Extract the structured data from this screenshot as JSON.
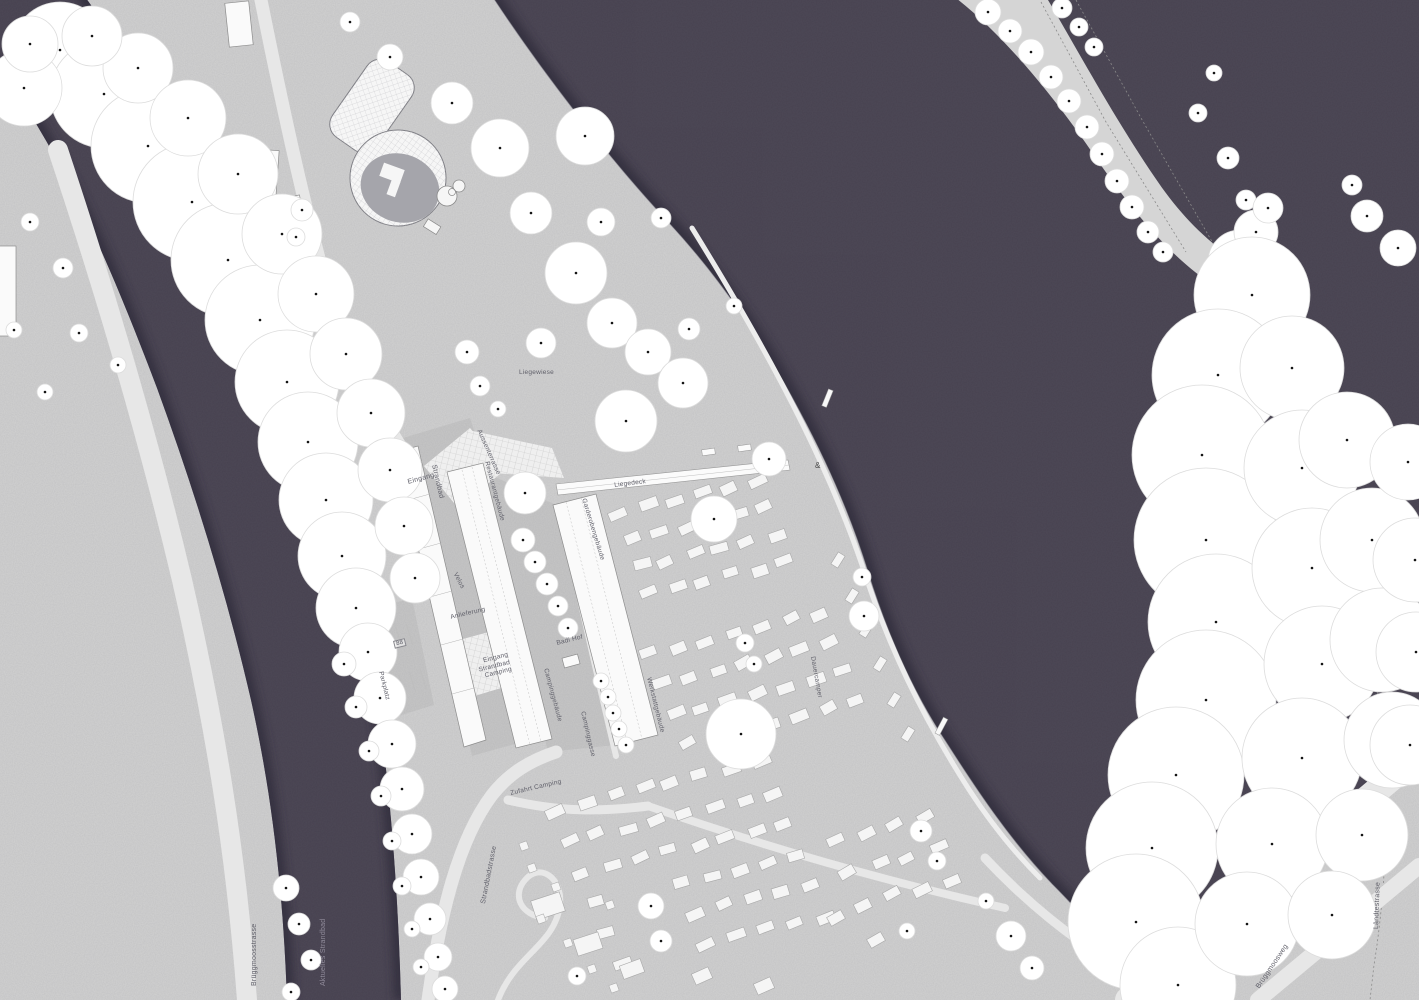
{
  "title": "Situationsplan Strandbad und Camping",
  "colors": {
    "ground": "#d2d2d2",
    "ground_patch": "#c1c1c1",
    "water": "#474250",
    "water_edge": "#322e3c",
    "tree_fill": "#ffffff",
    "tree_stroke": "#dcdcdc",
    "tree_dot": "#141414",
    "building_fill": "#fafafa",
    "building_stroke": "#8d8d8d",
    "caravan_fill": "#f5f5f5",
    "caravan_stroke": "#a8a8a8",
    "road": "#e7e7e7",
    "pool_gray": "#a5a5ab",
    "label": "#60606a",
    "label_on_water": "#928d9c"
  },
  "labels": [
    {
      "id": "liegewiese",
      "text": "Liegewiese",
      "x": 519,
      "y": 370,
      "rot": 0,
      "size": 6.5
    },
    {
      "id": "liegedeck",
      "text": "Liegedeck",
      "x": 614,
      "y": 483,
      "rot": -7,
      "size": 6.5
    },
    {
      "id": "eingang-strandbad",
      "text": "Eingang",
      "x": 407,
      "y": 479,
      "rot": -15
    },
    {
      "id": "strandbad-vertical",
      "text": "Strandbad",
      "x": 437,
      "y": 464,
      "rot": 77
    },
    {
      "id": "aussenterrasse",
      "text": "Aussenterrasse",
      "x": 481,
      "y": 429,
      "rot": 66,
      "size": 6.5
    },
    {
      "id": "restaurantgebaeude",
      "text": "Restaurantgebäude",
      "x": 489,
      "y": 461,
      "rot": 75,
      "size": 6.5
    },
    {
      "id": "garderobengebaeude",
      "text": "Garderobengebäude",
      "x": 586,
      "y": 498,
      "rot": 73,
      "size": 6.5
    },
    {
      "id": "werkstattgebaeude",
      "text": "Werkstattgebäude",
      "x": 651,
      "y": 677,
      "rot": 76,
      "size": 6.5
    },
    {
      "id": "campinggebaeude",
      "text": "Campinggebäude",
      "x": 548,
      "y": 668,
      "rot": 75,
      "size": 6.5
    },
    {
      "id": "campinggasse",
      "text": "Campinggasse",
      "x": 585,
      "y": 711,
      "rot": 77,
      "size": 6.5
    },
    {
      "id": "badi-hof",
      "text": "Badi Hof",
      "x": 556,
      "y": 641,
      "rot": -14,
      "size": 6.5
    },
    {
      "id": "anlieferung",
      "text": "Anlieferung",
      "x": 450,
      "y": 615,
      "rot": -13,
      "size": 6.5
    },
    {
      "id": "velos",
      "text": "Velos",
      "x": 457,
      "y": 572,
      "rot": 62,
      "size": 6.5
    },
    {
      "id": "eingang-camping",
      "lines": [
        "Eingang",
        "Strandbad",
        "Camping"
      ],
      "x": 476,
      "y": 659,
      "rot": -14,
      "align": "right",
      "size": 6.5
    },
    {
      "id": "dauercamper",
      "text": "Dauercamper",
      "x": 815,
      "y": 656,
      "rot": 80,
      "size": 6.5
    },
    {
      "id": "parkplatz",
      "text": "Parkplatz",
      "x": 383,
      "y": 671,
      "rot": 76,
      "size": 6.5
    },
    {
      "id": "parkplatz-count",
      "text": "88",
      "x": 393,
      "y": 641,
      "rot": -14,
      "size": 6,
      "boxed": true
    },
    {
      "id": "zufahrt-camping",
      "text": "Zufahrt Camping",
      "x": 510,
      "y": 791,
      "rot": -13,
      "size": 6.5
    },
    {
      "id": "strandbadstrasse",
      "text": "Strandbadstrasse",
      "x": 480,
      "y": 903,
      "rot": -79
    },
    {
      "id": "brueggmoosstrasse",
      "text": "Brüggmoosstrasse",
      "x": 251,
      "y": 986,
      "rot": -90
    },
    {
      "id": "aktuelles-strandbad",
      "text": "Aktuelles Strandbad",
      "x": 320,
      "y": 986,
      "rot": -90,
      "color": "#928d9c"
    },
    {
      "id": "brueggmoosweg",
      "text": "Brüggmoosweg",
      "x": 1255,
      "y": 986,
      "rot": -56
    },
    {
      "id": "laendtestrasse",
      "text": "Ländtestrasse",
      "x": 1373,
      "y": 929,
      "rot": -88
    },
    {
      "id": "shore-marker",
      "text": "&",
      "x": 815,
      "y": 462,
      "rot": 0,
      "size": 8,
      "color": "#4a4a4a"
    }
  ]
}
